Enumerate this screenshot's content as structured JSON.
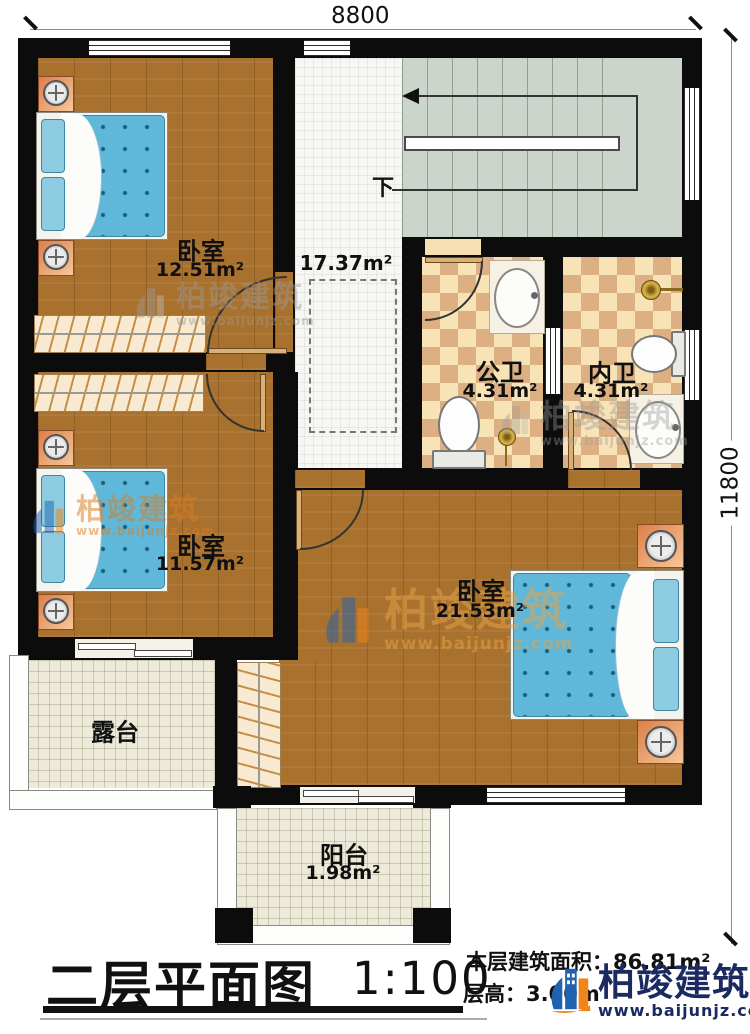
{
  "dimensions": {
    "width_label": "8800",
    "height_label": "11800"
  },
  "stairs": {
    "down_label": "下"
  },
  "rooms": {
    "bedroom1": {
      "name": "卧室",
      "area": "12.51m²"
    },
    "bedroom2": {
      "name": "卧室",
      "area": "11.57m²"
    },
    "master_bedroom": {
      "name": "卧室",
      "area": "21.53m²"
    },
    "public_bathroom": {
      "name": "公卫",
      "area": "4.31m²"
    },
    "ensuite_bathroom": {
      "name": "内卫",
      "area": "4.31m²"
    },
    "hallway": {
      "area": "17.37m²"
    },
    "terrace": {
      "name": "露台"
    },
    "balcony": {
      "name": "阳台",
      "area": "1.98m²"
    }
  },
  "title_block": {
    "title": "二层平面图",
    "scale": "1:100",
    "floor_area": "本层建筑面积：86.81m²",
    "floor_height": "层高：3.00m"
  },
  "branding": {
    "company": "柏竣建筑",
    "website": "www.baijunjz.com"
  },
  "colors": {
    "wall": "#0c0c0c",
    "wood_floor": "#a9712e",
    "bath_tile": "#f8e3b6",
    "stairs": "#ccd5cb",
    "mattress_blue": "#5fb7d9",
    "brand_orange": "#e8821e",
    "brand_blue": "#1f63b0",
    "brand_navy": "#1b2a60"
  }
}
